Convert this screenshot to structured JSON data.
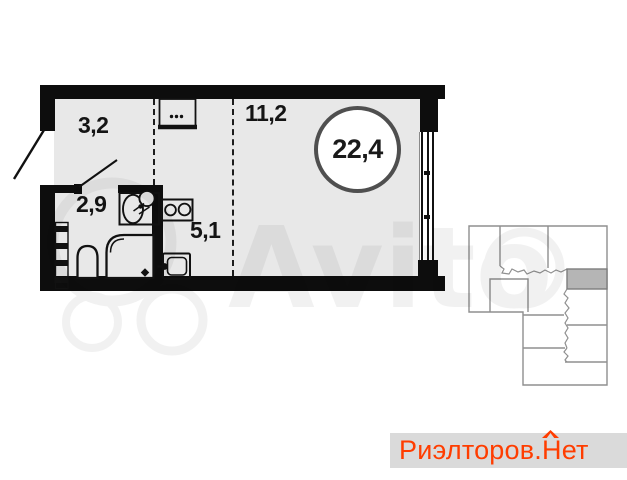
{
  "plan": {
    "room_areas": {
      "hallway": "3,2",
      "bathroom": "2,9",
      "kitchen": "5,1",
      "living_room": "11,2"
    },
    "total_area": "22,4"
  },
  "watermark": {
    "text": "Avito"
  },
  "brand": {
    "prefix": "Риэлторов.",
    "n": "Н",
    "suffix": "ет"
  },
  "colors": {
    "floor": "#e8e8e8",
    "wall": "#0d0d0d",
    "brand_orange": "#ff3d00",
    "strip_gray": "#dadada",
    "inset_highlighted_unit": "#b5b5b5"
  }
}
